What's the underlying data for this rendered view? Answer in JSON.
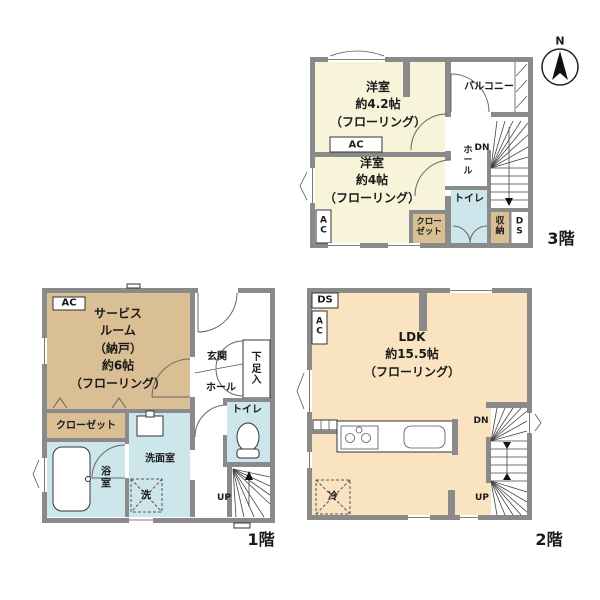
{
  "colors": {
    "wall_gray": "#8a8a8a",
    "room_cream": "#f7f4da",
    "closet_tan": "#d9bf93",
    "wet_blue": "#cde6ec",
    "ldk_peach": "#fae3c1"
  },
  "compass": {
    "north": "N"
  },
  "floor3": {
    "label": "3階",
    "room42": [
      "洋室",
      "約4.2帖",
      "（フローリング）"
    ],
    "room4": [
      "洋室",
      "約4帖",
      "（フローリング）"
    ],
    "ac_top": "AC",
    "ac_left": "A\nC",
    "balcony": "バルコニー",
    "hall": "ホ\nー\nル",
    "dn": "DN",
    "toilet": "トイレ",
    "closet": "クロー\nゼット",
    "storage": "収\n納",
    "ds": "D\nS"
  },
  "floor1": {
    "label": "1階",
    "ac": "AC",
    "service_room": [
      "サービス",
      "ルーム",
      "（納戸）",
      "約6帖",
      "（フローリング）"
    ],
    "closet": "クローゼット",
    "bath": "浴\n室",
    "washroom": "洗面室",
    "laundry": "洗",
    "entrance": "玄関",
    "hall": "ホール",
    "shoe_cabinet": "下\n足\n入",
    "toilet": "トイレ",
    "up": "UP"
  },
  "floor2": {
    "label": "2階",
    "ds": "DS",
    "ac": "A\nC",
    "ldk": [
      "LDK",
      "約15.5帖",
      "（フローリング）"
    ],
    "dn": "DN",
    "up": "UP",
    "fridge": "冷"
  }
}
